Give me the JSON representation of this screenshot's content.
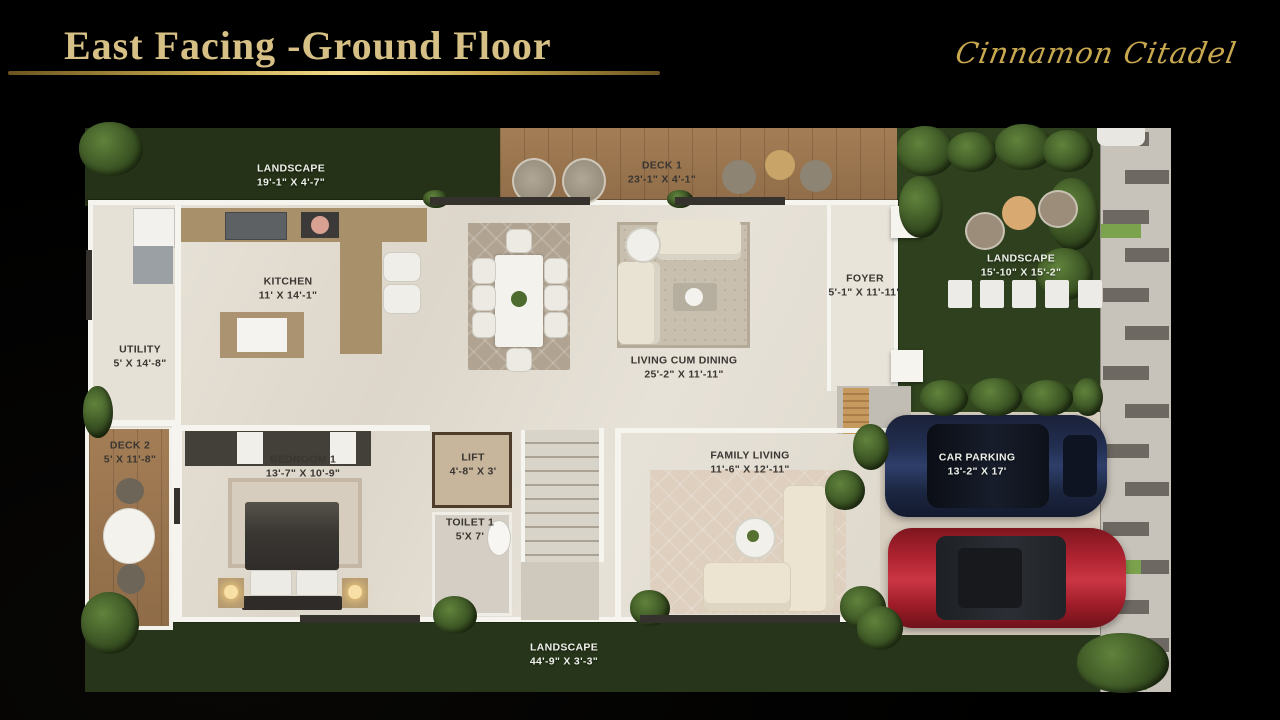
{
  "slide": {
    "title": "East Facing -Ground Floor",
    "brand": "Cinnamon Citadel"
  },
  "plan": {
    "rooms": {
      "landscape_top": {
        "name": "LANDSCAPE",
        "dims": "19'-1\" X 4'-7\""
      },
      "deck1": {
        "name": "DECK 1",
        "dims": "23'-1\" X 4'-1\""
      },
      "landscape_right": {
        "name": "LANDSCAPE",
        "dims": "15'-10\" X 15'-2\""
      },
      "kitchen": {
        "name": "KITCHEN",
        "dims": "11' X 14'-1\""
      },
      "utility": {
        "name": "UTILITY",
        "dims": "5' X 14'-8\""
      },
      "foyer": {
        "name": "FOYER",
        "dims": "5'-1\" X 11'-11\""
      },
      "living_dining": {
        "name": "LIVING CUM DINING",
        "dims": "25'-2\" X 11'-11\""
      },
      "deck2": {
        "name": "DECK 2",
        "dims": "5' X 11'-8\""
      },
      "bedroom1": {
        "name": "BEDROOM 1",
        "dims": "13'-7\" X 10'-9\""
      },
      "lift": {
        "name": "LIFT",
        "dims": "4'-8\" X 3'"
      },
      "toilet1": {
        "name": "TOILET 1",
        "dims": "5'X 7'"
      },
      "family_living": {
        "name": "FAMILY LIVING",
        "dims": "11'-6\" X 12'-11\""
      },
      "car_parking": {
        "name": "CAR PARKING",
        "dims": "13'-2\" X 17'"
      },
      "landscape_bottom": {
        "name": "LANDSCAPE",
        "dims": "44'-9\" X 3'-3\""
      }
    },
    "colors": {
      "background": "#17140f",
      "gold": "#d6c085",
      "grass": "#2c3a1d",
      "deck_wood": "#9a7650",
      "floor": "#e4dfd5",
      "car_navy": "#233055",
      "car_red": "#b42634",
      "walkway_bar": "#6e6862"
    }
  }
}
